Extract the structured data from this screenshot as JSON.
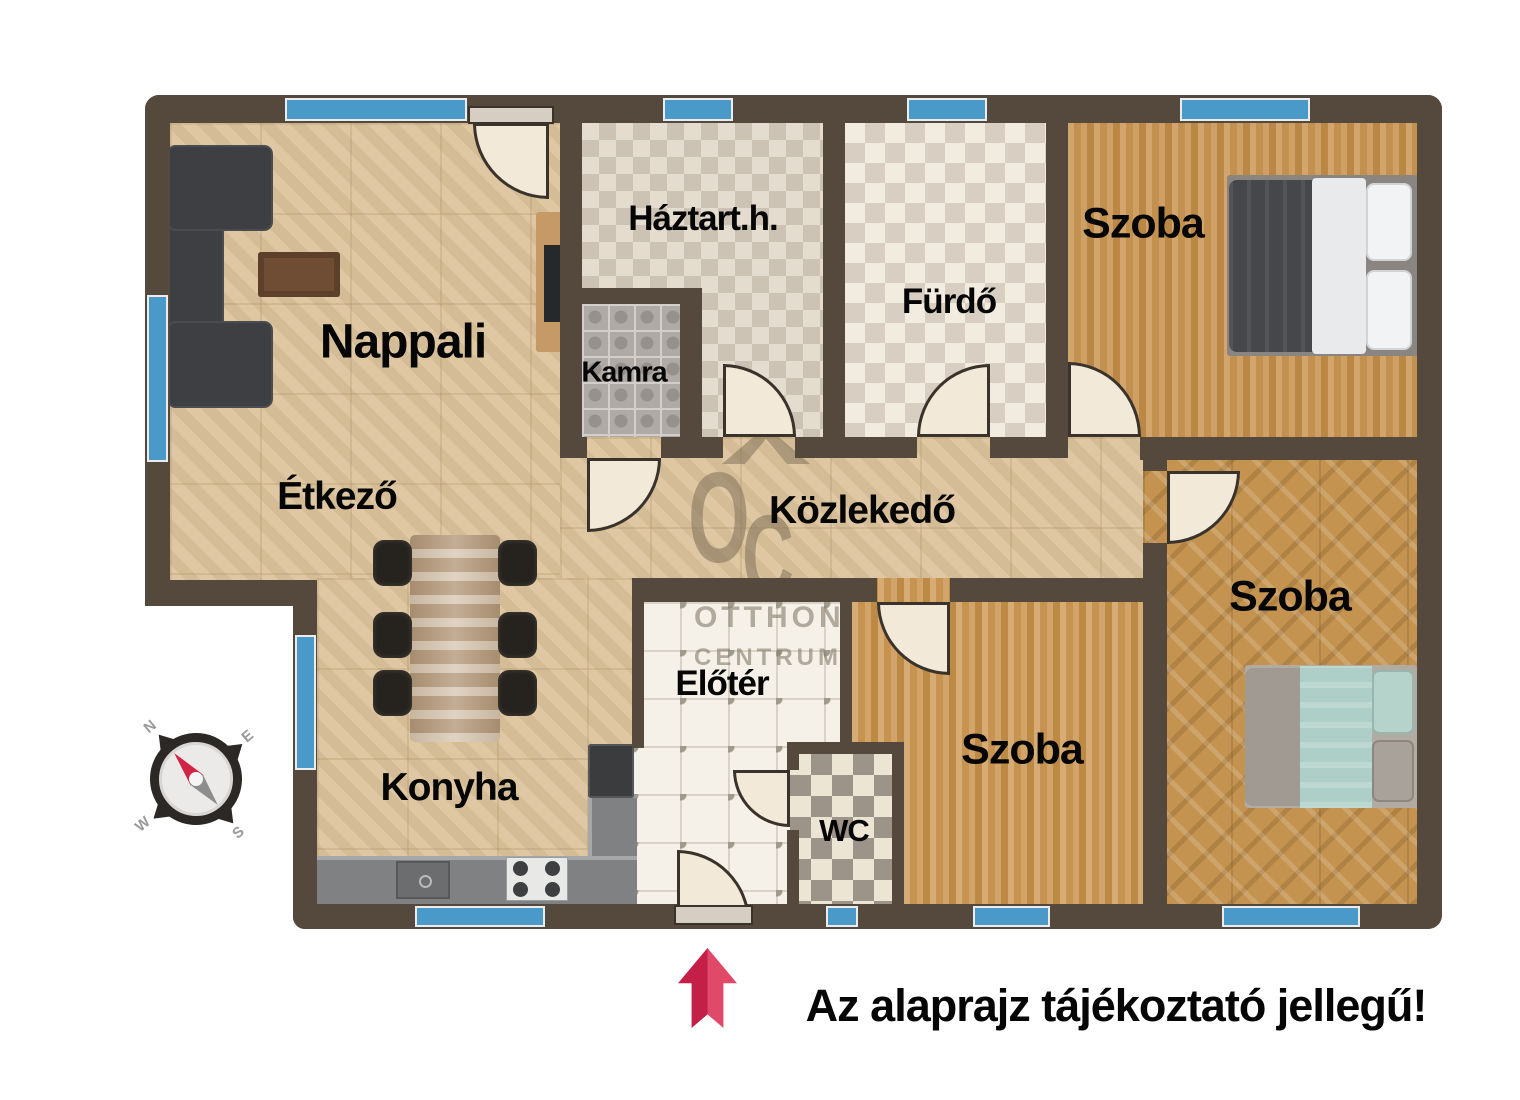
{
  "disclaimer": "Az alaprajz tájékoztató jellegű!",
  "watermark": {
    "o": "O",
    "c": "C",
    "line1": "OTTHON",
    "line2": "CENTRUM"
  },
  "compass": {
    "n": "N",
    "e": "E",
    "s": "S",
    "w": "W"
  },
  "rooms": {
    "nappali": {
      "label": "Nappali"
    },
    "haztartasi": {
      "label": "Háztart.h."
    },
    "kamra": {
      "label": "Kamra"
    },
    "furdo": {
      "label": "Fürdő"
    },
    "szoba_felso": {
      "label": "Szoba"
    },
    "etkezo": {
      "label": "Étkező"
    },
    "kozlekedo": {
      "label": "Közlekedő"
    },
    "eloter": {
      "label": "Előtér"
    },
    "szoba_kozepso": {
      "label": "Szoba"
    },
    "szoba_jobb": {
      "label": "Szoba"
    },
    "konyha": {
      "label": "Konyha"
    },
    "wc": {
      "label": "WC"
    }
  },
  "colors": {
    "wall": "#55493e",
    "window": "#4a9ac9",
    "parquet": "#dcc39b",
    "entrance_arrow": "#c92045",
    "watermark": "rgba(122,107,86,0.52)"
  }
}
